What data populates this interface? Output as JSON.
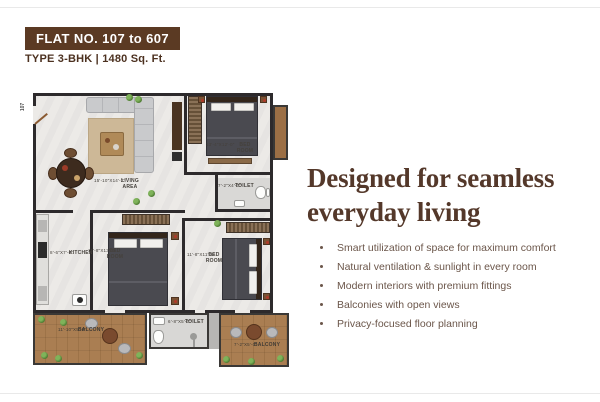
{
  "colors": {
    "accent_brown": "#5b3a23",
    "heading_brown": "#54382a",
    "body_text": "#6b564a",
    "wall": "#2d2a2c",
    "wood_deck": "#aa7e52"
  },
  "header": {
    "flat_badge": "FLAT NO. 107 to 607",
    "type_line": "TYPE 3-BHK | 1480 Sq. Ft."
  },
  "headline": {
    "line1": "Designed for seamless",
    "line2": "everyday living"
  },
  "features": [
    "Smart utilization of space for maximum comfort",
    "Natural ventilation & sunlight in every room",
    "Modern interiors with premium fittings",
    "Balconies with open views",
    "Privacy-focused floor planning"
  ],
  "floorplan": {
    "unit_number": "107",
    "rooms": {
      "living": {
        "name": "LIVING AREA",
        "dims": "15'-10\"X14'-2\""
      },
      "bedroom_top": {
        "name": "BED ROOM",
        "dims": "13'-4\"X12'-0\""
      },
      "bedroom_mid": {
        "name": "BED ROOM",
        "dims": "11'-8\"X13'-0\""
      },
      "bedroom_right": {
        "name": "BED ROOM",
        "dims": "11'-8\"X11'-4\""
      },
      "kitchen": {
        "name": "KITCHEN",
        "dims": "8'-6\"X7'-6\""
      },
      "toilet_right": {
        "name": "TOILET",
        "dims": "7'-2\"X4'-0\""
      },
      "toilet_bottom": {
        "name": "TOILET",
        "dims": "6'-8\"X5'-0\""
      },
      "balcony_left": {
        "name": "BALCONY",
        "dims": "11'-10\"X5'-0\""
      },
      "balcony_right": {
        "name": "BALCONY",
        "dims": "7'-2\"X5'-0\""
      }
    }
  }
}
